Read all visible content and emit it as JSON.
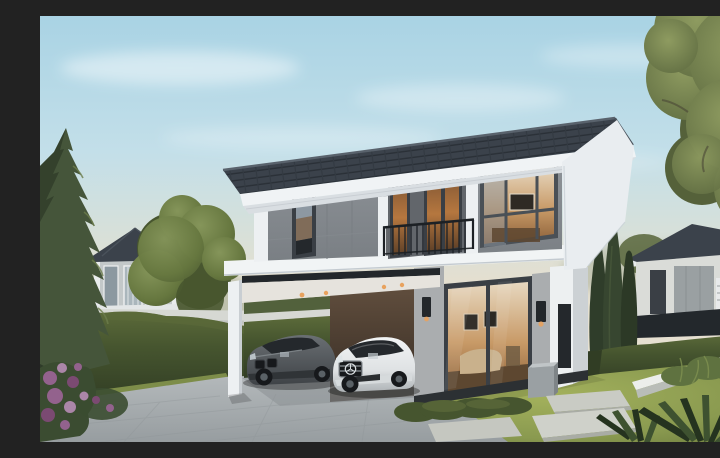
{
  "scene": {
    "kind": "3D architectural exterior rendering",
    "subject": "Modern two-story house with dark gray hip roof, gray panel upper facade, balcony with black railing, warm-lit interiors, open carport sheltering a dark gray sedan and a white sedan, paved driveway, lawn with stepping stones, tall hedges, pine and leafy trees, and neighboring houses under a soft blue evening sky"
  },
  "palette": {
    "sky_top": "#a9d3e4",
    "sky_mid": "#c3dfe9",
    "sky_horizon": "#e4dfd0",
    "roof": "#3b424b",
    "roof_line": "#2a3037",
    "fascia": "#f0f3f5",
    "soffit": "#d9dee2",
    "wall_gray": "#8d9297",
    "wall_gray_dark": "#7a7f84",
    "trim_white": "#edf0f2",
    "slab": "#f1f4f5",
    "frame": "#3a3f45",
    "glass_cool": "#8d98a2",
    "glass_dark": "#24282c",
    "interior_warm": "#c89a67",
    "interior_deep": "#8a5f38",
    "interior_dark": "#5d4730",
    "recess_wall": "#62666b",
    "railing": "#1d2125",
    "beam_dark": "#23272b",
    "ceiling": "#e6e3dd",
    "downlight": "#e8a25e",
    "brown_top": "#63503f",
    "brown_bottom": "#352b23",
    "shade_wall": "#aaadaf",
    "pillar": "#edf0f1",
    "side_wall": "#ccd1d4",
    "plinth": "#2c3033",
    "planter": "#9aa0a3",
    "drive_light": "#b7bcbe",
    "drive_dark": "#979da0",
    "lawn_light": "#a3b15c",
    "lawn": "#8a9a50",
    "lawn_dark": "#667539",
    "grass_strip": "#7d8d49",
    "hedge_light": "#5c6b3a",
    "hedge": "#46552f",
    "hedge_dark": "#313d24",
    "pine": "#45553a",
    "pine_dark": "#2f3c29",
    "pine_light": "#6d7d4c",
    "tree": "#66773f",
    "tree_light": "#85955a",
    "tree_dark": "#48562f",
    "rtree": "#6e7b4b",
    "rtree_light": "#8e9b60",
    "rtree_dark": "#55613a",
    "cypress": "#2f3d2a",
    "fence_wall": "#d6d8d3",
    "curb": "#eceeeb",
    "curb_side": "#b9bdb8",
    "stone": "#c9cbc4",
    "fern": "#5f7240",
    "spiky": "#25331f",
    "flower": "#93628d",
    "flower_dark": "#7b4a72",
    "flower_light": "#ab86a8",
    "bush": "#3b4c31",
    "neighbor_wall": "#c3c8c9",
    "neighbor_white": "#e9eced",
    "neighbor_glass": "#8b98a0",
    "rn_wall": "#dadcd8",
    "rn_panel": "#9aa0a2",
    "rn_dark": "#23282c",
    "car_gray": "#54585c",
    "car_gray_dark": "#3f4347",
    "car_white": "#f2f4f5",
    "car_white_dark": "#aeb3b6",
    "car_glass": "#24282c",
    "tire": "#17191c",
    "rim": "#5a6166"
  }
}
